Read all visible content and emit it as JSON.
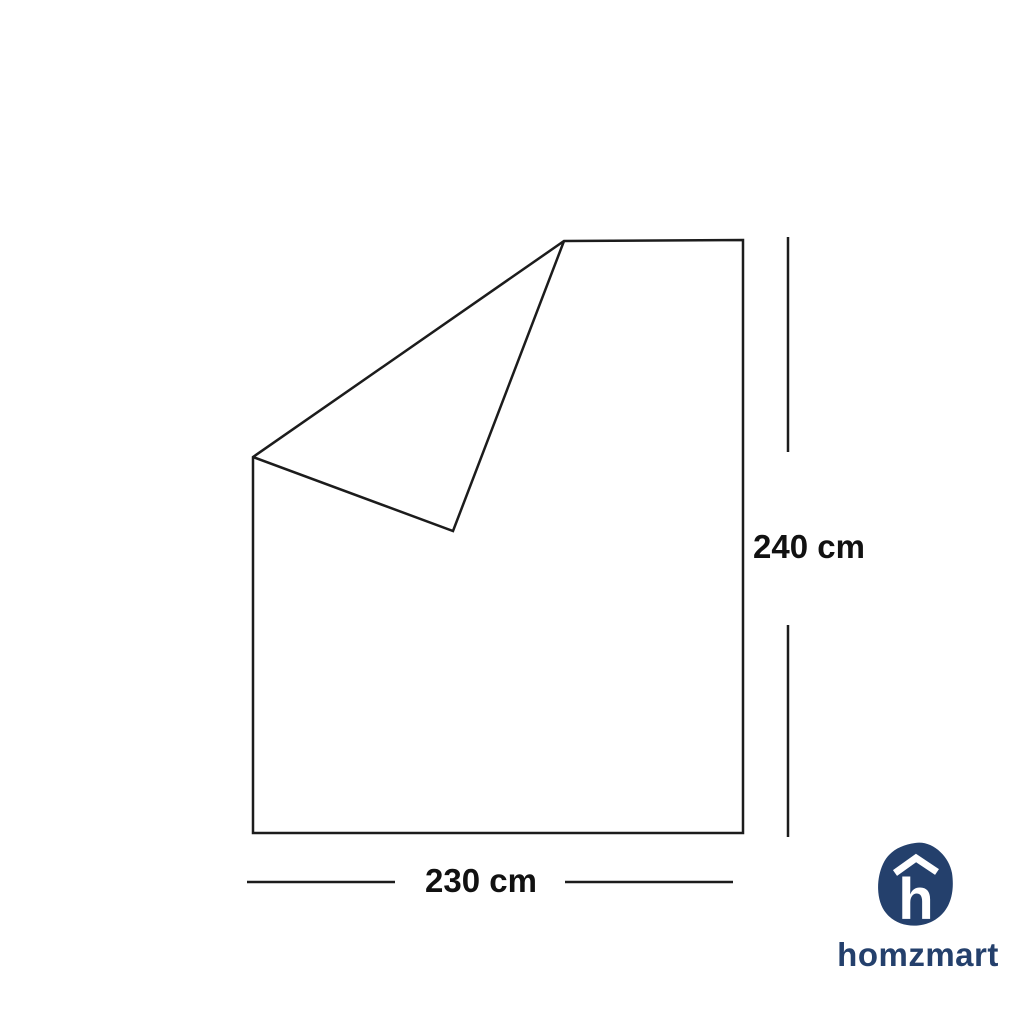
{
  "diagram": {
    "title": "sheet-with-folded-corner-dimension-diagram",
    "height_label": "240 cm",
    "width_label": "230 cm"
  },
  "branding": {
    "wordmark": "homzmart",
    "logo_letter": "h",
    "brand_color": "#24406c"
  },
  "colors": {
    "line": "#1c1c1c",
    "background": "#ffffff"
  }
}
